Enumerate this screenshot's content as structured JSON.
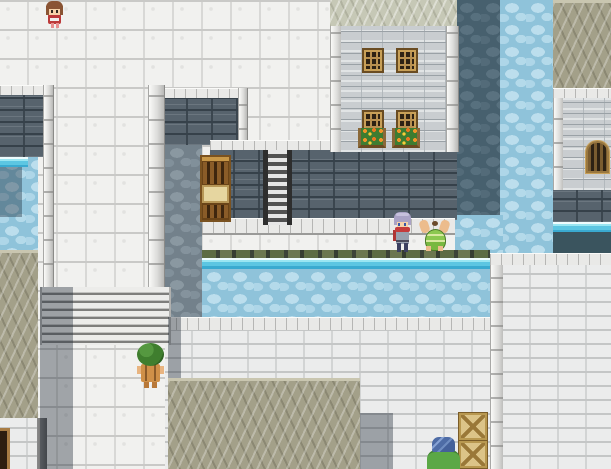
{
  "scene": {
    "title": "rpg-town-canal-map",
    "description": "Top-down pixel RPG town scene: white cobblestone plazas on several elevations, stone retaining walls, a cyan canal with pebbled water, two stone buildings with windows, rooftops, stairs, a ladder, wooden crates and five character sprites.",
    "view": "top-down tile map",
    "visible_text": ""
  },
  "palette": {
    "cobble": "#f1f1ef",
    "white_brick": "#ebecec",
    "building_wall": "#c9cdd0",
    "slate_wall": "#57636d",
    "water": "#8fc3da",
    "water_edge_cyan": "#5cc6e2",
    "water_shadow": "#47606e",
    "roof_tan": "#a3a089",
    "roof_pale": "#c6c8b6",
    "trim": "#e9e9e7",
    "wood_light": "#dcc488",
    "wood_dark": "#6a4418",
    "foliage": "#3e7c30",
    "flowers_orange": "#f09428"
  },
  "buildings": [
    {
      "id": "building-top",
      "label": "stone house with four six-pane windows and two flower boxes, pale shingled roof"
    },
    {
      "id": "building-right",
      "label": "stone house with arched lattice window, tan shingled roof, waterfall outlet below"
    },
    {
      "id": "building-bottom-left",
      "label": "lower building, white brick wall with dark doorway, tan roof strip"
    }
  ],
  "water_features": [
    {
      "id": "canal-horizontal",
      "label": "canal below walkway with cyan edge and mossy stone lip"
    },
    {
      "id": "canal-vertical-right",
      "label": "vertical water channel between buildings, partly in shadow"
    },
    {
      "id": "pool-left",
      "label": "small water pool at left edge with cyan lip"
    }
  ],
  "objects": [
    {
      "id": "stairs-lower-plaza",
      "label": "wide stone staircase down to lower plaza"
    },
    {
      "id": "metal-ladder",
      "label": "metal rung stairway down retaining wall"
    },
    {
      "id": "wooden-shelf-stack",
      "label": "stack of wooden shelves and a crate against retaining wall"
    },
    {
      "id": "crate-stack-bottom-right",
      "label": "two wooden crates with X bracing"
    },
    {
      "id": "door-bottom-left",
      "label": "dark doorway in white brick wall"
    },
    {
      "id": "windows-front",
      "label": "four brown framed six-pane windows"
    },
    {
      "id": "flower-boxes",
      "label": "two window flower boxes with orange and yellow blossoms"
    },
    {
      "id": "arch-window",
      "label": "arched brown lattice window"
    }
  ],
  "characters": [
    {
      "id": "girl-top-left",
      "appearance": "girl with brown bob hair and red dress, facing south",
      "position": "upper terrace, top-left"
    },
    {
      "id": "hero-purple-hair",
      "appearance": "hero with lavender spiky hair, red scarf, gray tunic, facing south",
      "position": "canal walkway, center-right"
    },
    {
      "id": "villager-crouching",
      "appearance": "villager in green striped clothes bent over, arms out",
      "position": "canal walkway, right of hero"
    },
    {
      "id": "villager-green-afro",
      "appearance": "villager with large green bushy hair and orange overalls, facing north",
      "position": "lower plaza, bottom-left"
    },
    {
      "id": "traveler-green-cloak",
      "appearance": "traveler with spiky blue hair and green cloak, facing north",
      "position": "bottom edge near crates"
    }
  ]
}
